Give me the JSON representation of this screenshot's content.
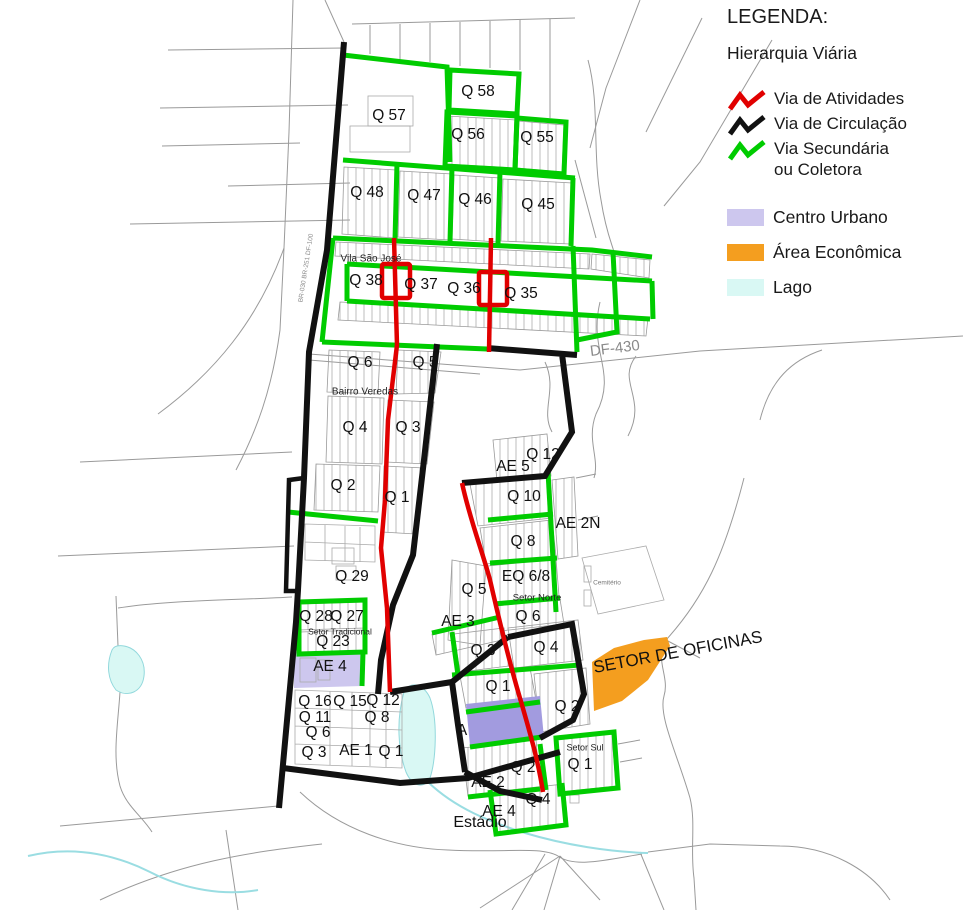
{
  "legend": {
    "title": "LEGENDA:",
    "subtitle": "Hierarquia Viária",
    "items": [
      {
        "label": "Via de Atividades",
        "swatch": "zigzag",
        "color": "#e10000"
      },
      {
        "label": "Via de Circulação",
        "swatch": "zigzag",
        "color": "#111111"
      },
      {
        "label": "Via Secundária",
        "label2": "ou Coletora",
        "swatch": "zigzag",
        "color": "#00cc00"
      },
      {
        "label": "Centro Urbano",
        "swatch": "square",
        "color": "#cdc7ee"
      },
      {
        "label": "Área Econômica",
        "swatch": "square",
        "color": "#f49e1f"
      },
      {
        "label": "Lago",
        "swatch": "square",
        "color": "#d9f8f4"
      }
    ]
  },
  "colors": {
    "via_atividades": "#e10000",
    "via_circulacao": "#111111",
    "via_secundaria": "#00cc00",
    "centro_urbano": "#cdc7ee",
    "centro_urbano_fill": "#a29bdf",
    "area_economica": "#f49e1f",
    "lago": "#d9f8f4",
    "background_road": "#9a9a9a"
  },
  "map": {
    "labels": [
      {
        "n": "q57",
        "t": "Q 57",
        "x": 389,
        "y": 116
      },
      {
        "n": "q58",
        "t": "Q 58",
        "x": 478,
        "y": 92
      },
      {
        "n": "q56",
        "t": "Q 56",
        "x": 468,
        "y": 135
      },
      {
        "n": "q55",
        "t": "Q 55",
        "x": 537,
        "y": 138
      },
      {
        "n": "q48",
        "t": "Q 48",
        "x": 367,
        "y": 193
      },
      {
        "n": "q47",
        "t": "Q 47",
        "x": 424,
        "y": 196
      },
      {
        "n": "q46",
        "t": "Q 46",
        "x": 475,
        "y": 200
      },
      {
        "n": "q45",
        "t": "Q 45",
        "x": 538,
        "y": 205
      },
      {
        "n": "vila-sao-jose",
        "t": "Vila São José",
        "x": 371,
        "y": 259,
        "s": 10,
        "c": "#222222"
      },
      {
        "n": "q38",
        "t": "Q 38",
        "x": 366,
        "y": 281
      },
      {
        "n": "q37",
        "t": "Q 37",
        "x": 421,
        "y": 285
      },
      {
        "n": "q36",
        "t": "Q 36",
        "x": 464,
        "y": 289
      },
      {
        "n": "q35",
        "t": "Q 35",
        "x": 521,
        "y": 294
      },
      {
        "n": "df-430",
        "t": "DF-430",
        "x": 615,
        "y": 349,
        "s": 15,
        "r": -7,
        "c": "#8a8a8a"
      },
      {
        "n": "br-road",
        "t": "BR-030 BR-251 DF-100",
        "x": 306,
        "y": 268,
        "s": 6.5,
        "r": -81,
        "c": "#8a8a8a"
      },
      {
        "n": "bv-q6",
        "t": "Q 6",
        "x": 360,
        "y": 363
      },
      {
        "n": "bv-q5",
        "t": "Q 5",
        "x": 425,
        "y": 363
      },
      {
        "n": "bairro-veredas",
        "t": "Bairro Veredas",
        "x": 365,
        "y": 392,
        "s": 10,
        "c": "#222222"
      },
      {
        "n": "bv-q4",
        "t": "Q 4",
        "x": 355,
        "y": 428
      },
      {
        "n": "bv-q3",
        "t": "Q 3",
        "x": 408,
        "y": 428
      },
      {
        "n": "bv-q2",
        "t": "Q 2",
        "x": 343,
        "y": 486
      },
      {
        "n": "bv-q1",
        "t": "Q 1",
        "x": 397,
        "y": 498
      },
      {
        "n": "q29",
        "t": "Q 29",
        "x": 352,
        "y": 577
      },
      {
        "n": "ae5",
        "t": "AE 5",
        "x": 513,
        "y": 467
      },
      {
        "n": "q12-right",
        "t": "Q 12",
        "x": 543,
        "y": 455
      },
      {
        "n": "q10",
        "t": "Q 10",
        "x": 524,
        "y": 497
      },
      {
        "n": "ae2n",
        "t": "AE 2N",
        "x": 578,
        "y": 524
      },
      {
        "n": "q8-right",
        "t": "Q 8",
        "x": 523,
        "y": 542
      },
      {
        "n": "eq-6-8",
        "t": "EQ 6/8",
        "x": 526,
        "y": 577
      },
      {
        "n": "sn-q5",
        "t": "Q 5",
        "x": 474,
        "y": 590
      },
      {
        "n": "setor-norte",
        "t": "Setor Norte",
        "x": 537,
        "y": 598,
        "s": 9.5,
        "c": "#222222"
      },
      {
        "n": "cemiterio",
        "t": "Cemitério",
        "x": 607,
        "y": 583,
        "s": 6.5,
        "c": "#777777"
      },
      {
        "n": "sn-q6",
        "t": "Q 6",
        "x": 528,
        "y": 617
      },
      {
        "n": "ae3",
        "t": "AE 3",
        "x": 458,
        "y": 622
      },
      {
        "n": "sn-q3",
        "t": "Q 3",
        "x": 483,
        "y": 651
      },
      {
        "n": "sn-q4",
        "t": "Q 4",
        "x": 546,
        "y": 648
      },
      {
        "n": "sn-q1",
        "t": "Q 1",
        "x": 498,
        "y": 687
      },
      {
        "n": "sn-q2",
        "t": "Q 2",
        "x": 567,
        "y": 707
      },
      {
        "n": "q28",
        "t": "Q 28",
        "x": 316,
        "y": 617
      },
      {
        "n": "q27",
        "t": "Q 27",
        "x": 347,
        "y": 617
      },
      {
        "n": "setor-tradicional",
        "t": "Setor Tradicional",
        "x": 340,
        "y": 632,
        "s": 8.5,
        "c": "#222222"
      },
      {
        "n": "q23",
        "t": "Q 23",
        "x": 333,
        "y": 642
      },
      {
        "n": "ae4-left",
        "t": "AE 4",
        "x": 330,
        "y": 667
      },
      {
        "n": "q16",
        "t": "Q 16",
        "x": 315,
        "y": 702
      },
      {
        "n": "q15",
        "t": "Q 15",
        "x": 350,
        "y": 702
      },
      {
        "n": "q12-left",
        "t": "Q 12",
        "x": 383,
        "y": 701
      },
      {
        "n": "q11",
        "t": "Q 11",
        "x": 315,
        "y": 718
      },
      {
        "n": "q8-left",
        "t": "Q 8",
        "x": 377,
        "y": 718
      },
      {
        "n": "q6-left",
        "t": "Q 6",
        "x": 318,
        "y": 733
      },
      {
        "n": "q3-left",
        "t": "Q 3",
        "x": 314,
        "y": 753
      },
      {
        "n": "ae1",
        "t": "AE 1",
        "x": 356,
        "y": 751
      },
      {
        "n": "q1-left",
        "t": "Q 1",
        "x": 391,
        "y": 752
      },
      {
        "n": "a-mark",
        "t": "A",
        "x": 462,
        "y": 731
      },
      {
        "n": "setor-de-oficinas",
        "t": "SETOR DE OFICINAS",
        "x": 678,
        "y": 653,
        "s": 17,
        "r": -10.5
      },
      {
        "n": "setor-sul",
        "t": "Setor Sul",
        "x": 585,
        "y": 748,
        "s": 9,
        "c": "#222222"
      },
      {
        "n": "ss-q2",
        "t": "Q 2",
        "x": 523,
        "y": 768
      },
      {
        "n": "ss-q1",
        "t": "Q 1",
        "x": 580,
        "y": 765
      },
      {
        "n": "ae2",
        "t": "AE 2",
        "x": 488,
        "y": 783
      },
      {
        "n": "ss-q4",
        "t": "Q 4",
        "x": 538,
        "y": 800
      },
      {
        "n": "ae4-bottom",
        "t": "AE 4",
        "x": 499,
        "y": 812
      },
      {
        "n": "estadio",
        "t": "Estádio",
        "x": 480,
        "y": 823,
        "s": 16
      }
    ]
  }
}
